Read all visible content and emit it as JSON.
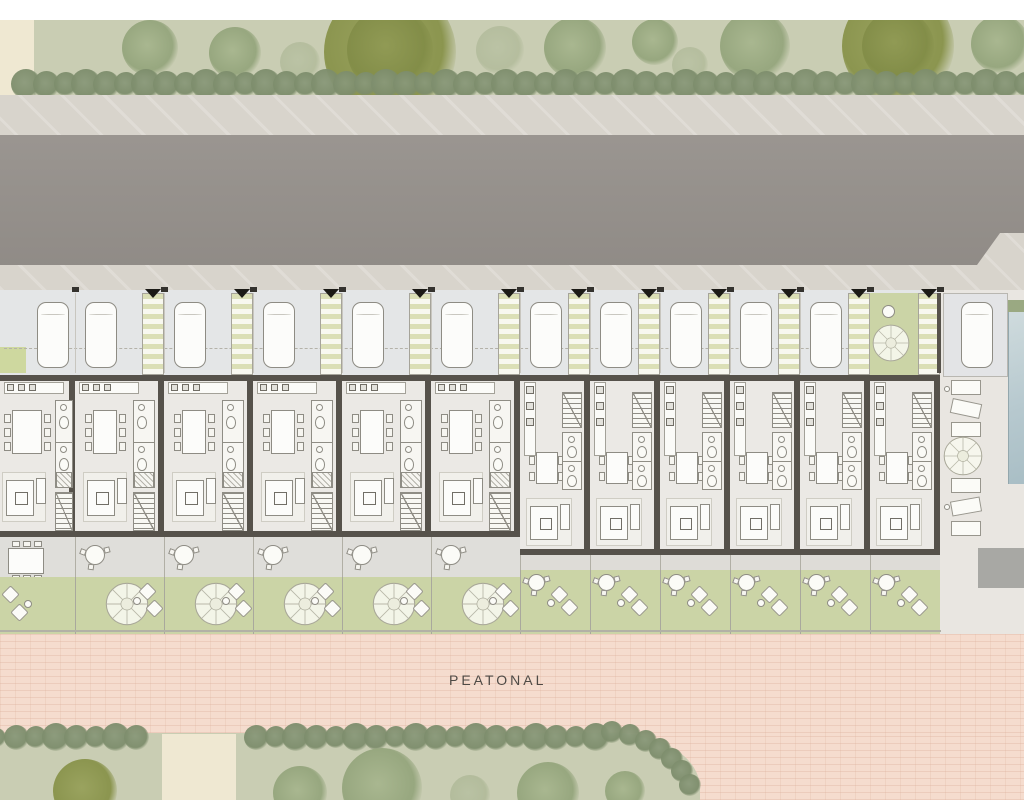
{
  "site": {
    "walkway_label": "PEATONAL",
    "units": {
      "corner_unit_count": 1,
      "type_a_unit_count": 5,
      "type_b_unit_count": 6
    },
    "parking": {
      "cars_visible": 12,
      "entrance_walkways": 11,
      "communal_courtyards": 1
    },
    "amenities": {
      "swimming_pool_count": 1,
      "deck_lounger_count": 6,
      "garden_tree_count": 5
    },
    "colors": {
      "background": "#ffffff",
      "greenbelt": "#c9cdb3",
      "hedge": "#8d9c7c",
      "sidewalk": "#d8d4cc",
      "road": "#96918c",
      "parking": "#e4e6e7",
      "stripe": "#dbdfb6",
      "wall": "#56524b",
      "floor": "#ebe9e5",
      "terrace": "#dfdeda",
      "garden": "#cbd4a6",
      "walkway": "#f5dcce",
      "pool": "#b7c9cf",
      "deck": "#e9e6e1",
      "cream": "#efe8d2",
      "label": "#4e4a45"
    }
  }
}
